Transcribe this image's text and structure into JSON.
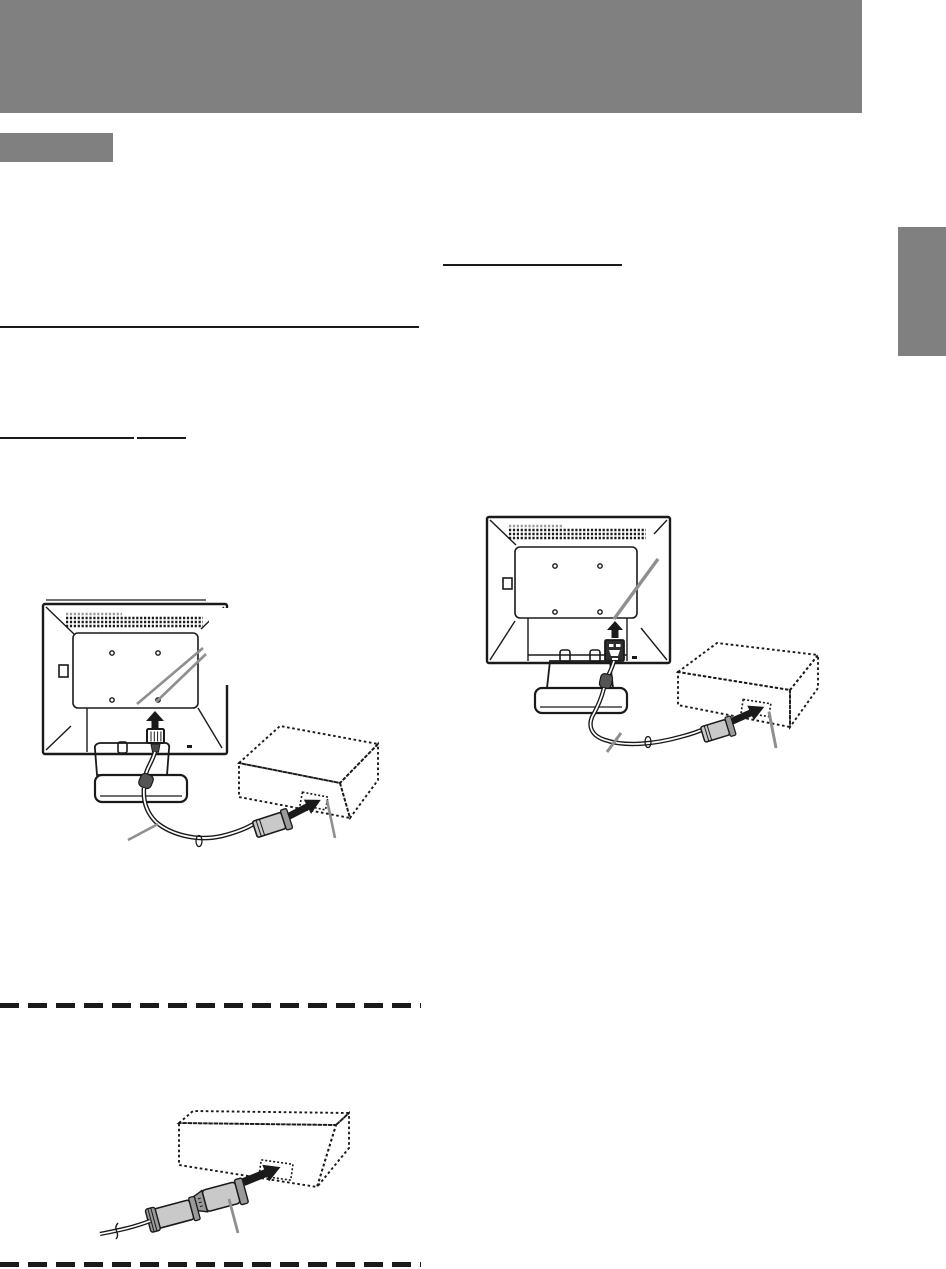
{
  "page": {
    "width": 946,
    "height": 1269,
    "background": "#ffffff",
    "kind": "user-manual page — monitor connection diagrams (no text rendered on page)"
  },
  "colors": {
    "header_gray": "#808080",
    "line_black": "#1a1a1a",
    "callout_gray": "#8f8f8f",
    "connector_light": "#c9c9c9",
    "connector_mid": "#9a9a9a",
    "connector_dark": "#2e2e2e",
    "boot_dark": "#4a4a4a",
    "bead_gray": "#555555",
    "vent_gray": "#9a9a9a",
    "white": "#ffffff"
  },
  "header": {
    "bar": {
      "x": 0,
      "y": 0,
      "width": 862,
      "height": 113
    }
  },
  "section_label_box": {
    "x": 0,
    "y": 133,
    "width": 113,
    "height": 29
  },
  "side_tab": {
    "x": 898,
    "y": 227,
    "width": 48,
    "height": 129
  },
  "rules": {
    "left_heading_rule": {
      "x1": 0,
      "x2": 419,
      "y": 326,
      "thickness": 2
    },
    "left_subheading_rule_segments": [
      {
        "x1": 0,
        "x2": 134,
        "y": 437,
        "thickness": 2
      },
      {
        "x1": 137,
        "x2": 186,
        "y": 437,
        "thickness": 2
      }
    ],
    "right_heading_rule": {
      "x1": 443,
      "x2": 622,
      "y": 264,
      "thickness": 2
    },
    "dashed_divider_top": {
      "x1": 0,
      "x2": 421,
      "y": 1003,
      "thickness": 5,
      "dash": [
        19,
        9
      ]
    },
    "dashed_divider_bottom": {
      "x1": 0,
      "x2": 421,
      "y": 1262,
      "thickness": 5,
      "dash": [
        19,
        9
      ]
    }
  },
  "diagrams": {
    "analog_connection": {
      "position": {
        "x": 35,
        "y": 595,
        "width": 360,
        "height": 265
      },
      "parts": [
        "monitor-rear",
        "vent-grid",
        "vesa-plate",
        "screw-holes",
        "stand-base",
        "up-arrow",
        "analog-signal-connector",
        "signal-cable",
        "ferrite-bead",
        "computer-dashed-box",
        "port-dashed",
        "insert-arrow",
        "cable-end-connector",
        "two-callout-lines",
        "port-callout",
        "cable-callout"
      ]
    },
    "digital_connection": {
      "position": {
        "x": 480,
        "y": 505,
        "width": 360,
        "height": 260
      },
      "parts": [
        "monitor-rear",
        "vent-grid",
        "vesa-plate",
        "screw-holes",
        "cable-clips",
        "stand-base",
        "up-arrow",
        "digital-signal-connector",
        "signal-cable",
        "ferrite-bead",
        "computer-dashed-box",
        "port-dashed",
        "insert-arrow",
        "cable-end-connector",
        "connector-callout",
        "port-callout",
        "cable-callout"
      ]
    },
    "adapter_connection": {
      "position": {
        "x": 95,
        "y": 1095,
        "width": 270,
        "height": 150
      },
      "parts": [
        "computer-dashed-box",
        "port-dashed",
        "insert-arrow",
        "conversion-adapter",
        "cable-end-connector",
        "cable-break-mark",
        "adapter-callout"
      ]
    }
  }
}
